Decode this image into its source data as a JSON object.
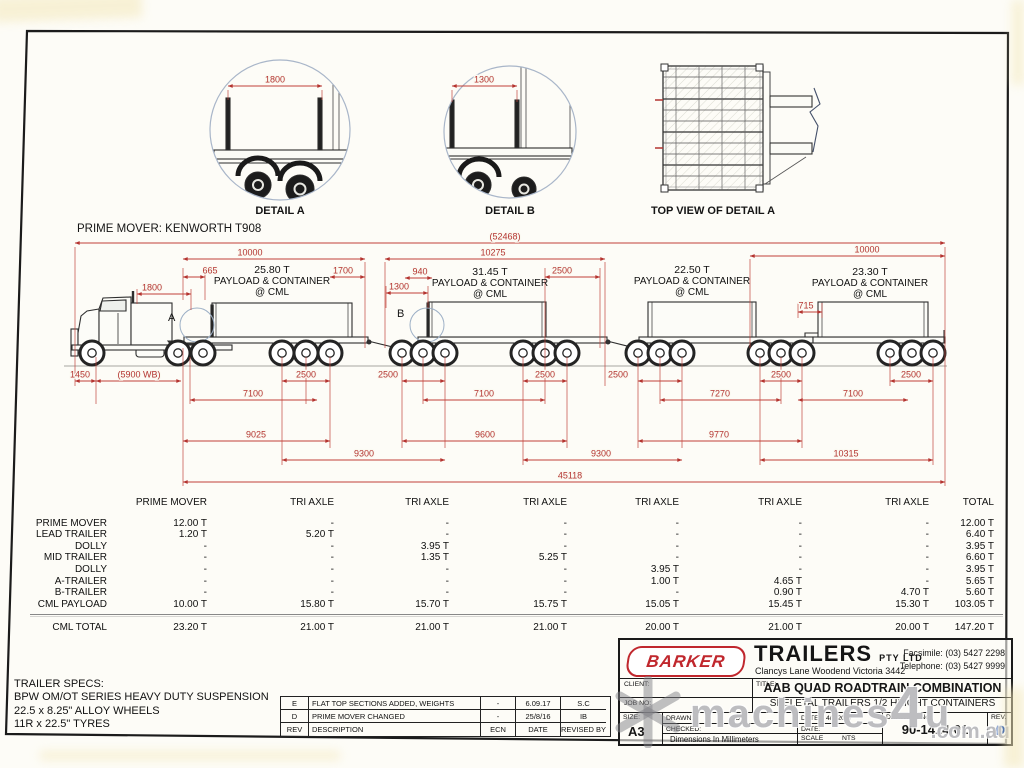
{
  "details": {
    "a": {
      "label": "DETAIL A",
      "dim": "1800"
    },
    "b": {
      "label": "DETAIL B",
      "dim": "1300"
    },
    "top": {
      "label": "TOP VIEW OF DETAIL A"
    }
  },
  "drawing": {
    "prime_mover_label": "PRIME MOVER: KENWORTH T908",
    "markers": {
      "a": "A",
      "b": "B"
    },
    "payloads": [
      {
        "weight": "25.80 T",
        "line2": "PAYLOAD & CONTAINER",
        "line3": "@ CML"
      },
      {
        "weight": "31.45 T",
        "line2": "PAYLOAD & CONTAINER",
        "line3": "@ CML"
      },
      {
        "weight": "22.50 T",
        "line2": "PAYLOAD & CONTAINER",
        "line3": "@ CML"
      },
      {
        "weight": "23.30 T",
        "line2": "PAYLOAD & CONTAINER",
        "line3": "@ CML"
      }
    ],
    "dims": {
      "overall": "(52468)",
      "trailer_total": "45118",
      "span1": "10000",
      "span2": "10275",
      "span3": "10000",
      "d665": "665",
      "d1700": "1700",
      "d940": "940",
      "d2500c": "2500",
      "d715": "715",
      "d1800": "1800",
      "d1300": "1300",
      "d1450": "1450",
      "wb": "(5900 WB)",
      "axle_spreads": [
        "2500",
        "2500",
        "2500",
        "2500",
        "2500",
        "2500"
      ],
      "r7100a": "7100",
      "r7100b": "7100",
      "r7270": "7270",
      "r7100c": "7100",
      "r9025": "9025",
      "r9600": "9600",
      "r9770": "9770",
      "r9300a": "9300",
      "r9300b": "9300",
      "r10315": "10315"
    }
  },
  "table": {
    "columns": [
      "PRIME MOVER",
      "TRI AXLE",
      "TRI AXLE",
      "TRI AXLE",
      "TRI AXLE",
      "TRI AXLE",
      "TRI AXLE",
      "TOTAL"
    ],
    "rows": [
      {
        "label": "PRIME MOVER",
        "cells": [
          "12.00 T",
          "-",
          "-",
          "-",
          "-",
          "-",
          "-",
          "12.00 T"
        ]
      },
      {
        "label": "LEAD TRAILER",
        "cells": [
          "1.20 T",
          "5.20 T",
          "-",
          "-",
          "-",
          "-",
          "-",
          "6.40 T"
        ]
      },
      {
        "label": "DOLLY",
        "cells": [
          "-",
          "-",
          "3.95 T",
          "-",
          "-",
          "-",
          "-",
          "3.95 T"
        ]
      },
      {
        "label": "MID TRAILER",
        "cells": [
          "-",
          "-",
          "1.35 T",
          "5.25 T",
          "-",
          "-",
          "-",
          "6.60 T"
        ]
      },
      {
        "label": "DOLLY",
        "cells": [
          "-",
          "-",
          "-",
          "-",
          "3.95 T",
          "-",
          "-",
          "3.95 T"
        ]
      },
      {
        "label": "A-TRAILER",
        "cells": [
          "-",
          "-",
          "-",
          "-",
          "1.00 T",
          "4.65 T",
          "-",
          "5.65 T"
        ]
      },
      {
        "label": "B-TRAILER",
        "cells": [
          "-",
          "-",
          "-",
          "-",
          "-",
          "0.90 T",
          "4.70 T",
          "5.60 T"
        ]
      },
      {
        "label": "CML PAYLOAD",
        "cells": [
          "10.00 T",
          "15.80 T",
          "15.70 T",
          "15.75 T",
          "15.05 T",
          "15.45 T",
          "15.30 T",
          "103.05 T"
        ]
      },
      {
        "label": "CML TOTAL",
        "cells": [
          "23.20 T",
          "21.00 T",
          "21.00 T",
          "21.00 T",
          "20.00 T",
          "21.00 T",
          "20.00 T",
          "147.20 T"
        ],
        "total": true
      }
    ]
  },
  "specs": {
    "title": "TRAILER SPECS:",
    "lines": [
      "BPW OM/OT SERIES HEAVY DUTY SUSPENSION",
      "22.5 x 8.25\" ALLOY WHEELS",
      "11R x 22.5\" TYRES"
    ]
  },
  "revisions": {
    "headers": [
      "REV",
      "DESCRIPTION",
      "ECN",
      "DATE",
      "REVISED BY"
    ],
    "rows": [
      {
        "rev": "E",
        "description": "FLAT TOP SECTIONS ADDED, WEIGHTS ADJUSTED",
        "ecn": "-",
        "date": "6.09.17",
        "by": "S.C"
      },
      {
        "rev": "D",
        "description": "PRIME MOVER CHANGED",
        "ecn": "-",
        "date": "25/8/16",
        "by": "IB"
      }
    ]
  },
  "titleblock": {
    "brand": "BARKER",
    "company": "TRAILERS",
    "company_suffix": "PTY LTD",
    "address": "Clancys Lane Woodend Victoria 3442",
    "facsimile": "Facsimile: (03) 5427 2298",
    "telephone": "Telephone: (03) 5427 9999",
    "client_label": "CLIENT:",
    "job_label": "JOB NO:",
    "title_label": "TITLE:",
    "title1": "AAB QUAD ROADTRAIN COMBINATION",
    "title2": "SKELETAL TRAILERS 1/2 HEIGHT CONTAINERS",
    "size_label": "SIZE:",
    "size": "A3",
    "drawn_label": "DRAWN:",
    "drawn": "JD",
    "date1_label": "DATE:",
    "date1": "4/7/2017",
    "checked_label": "CHECKED:",
    "date2_label": "DATE:",
    "dims_note": "Dimensions In Millimeters",
    "scale_label": "SCALE",
    "scale": "NTS",
    "drawing_no_label": "DRAWING No:",
    "drawing_no": "90-1414-01",
    "rev_label": "REV.",
    "rev": "D"
  },
  "watermark": {
    "text1": "machines",
    "text2": "4",
    "text3": "u",
    "suffix": ".com.au"
  },
  "colors": {
    "dim_red": "#b43430",
    "logo_red": "#c0272d",
    "rev_blue": "#1d4ea6"
  }
}
